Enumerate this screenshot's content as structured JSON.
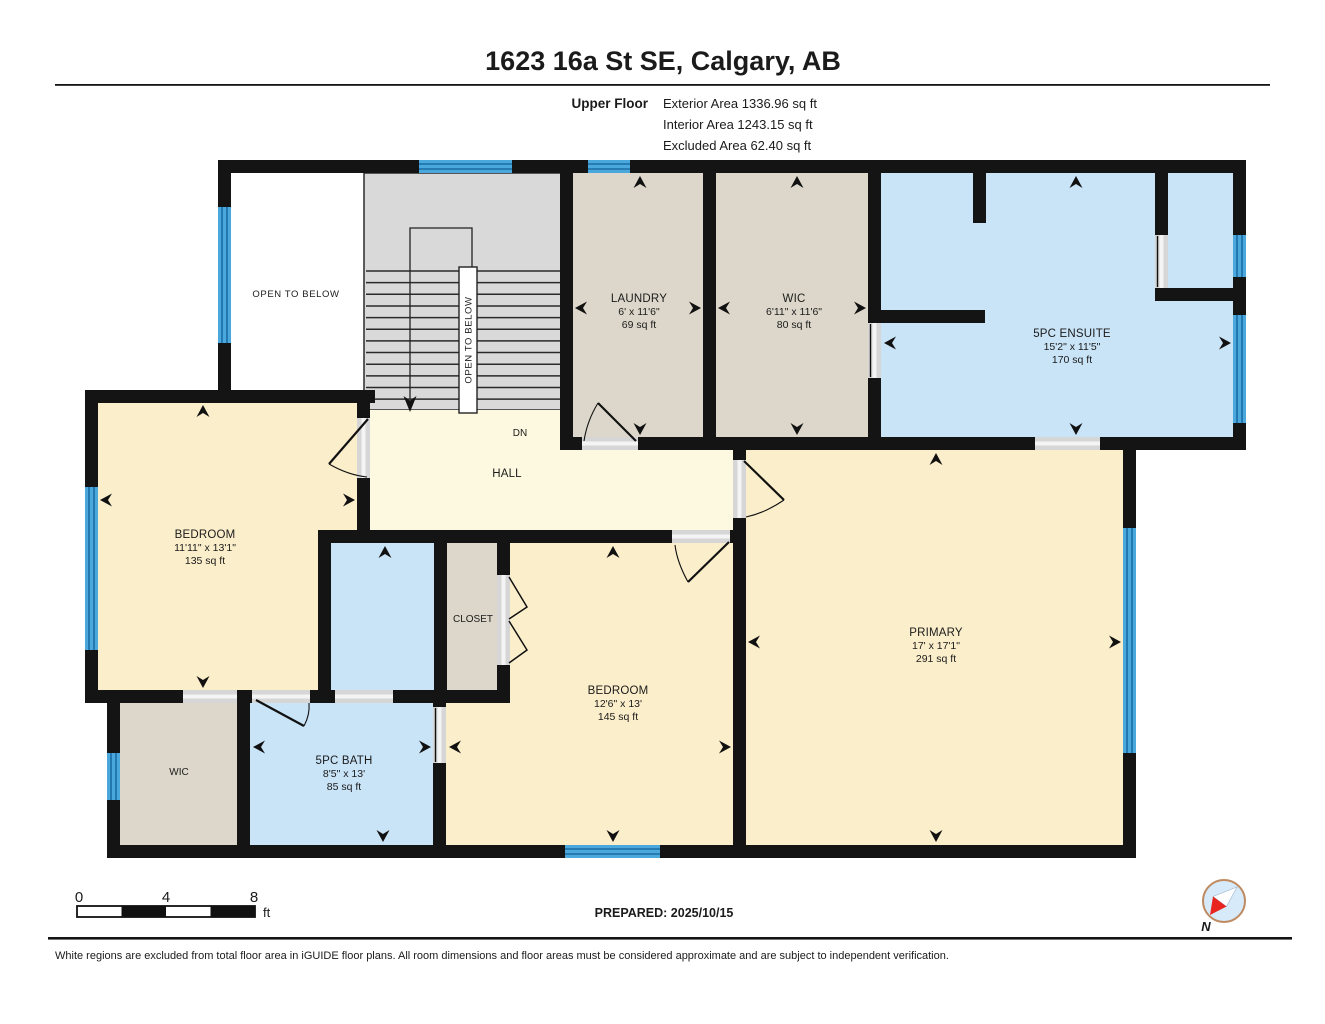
{
  "header": {
    "title": "1623 16a St SE, Calgary, AB",
    "floor_label": "Upper Floor",
    "exterior_area": "Exterior Area 1336.96 sq ft",
    "interior_area": "Interior Area 1243.15 sq ft",
    "excluded_area": "Excluded Area 62.40 sq ft"
  },
  "rooms": {
    "open_to_below": {
      "name": "OPEN TO BELOW"
    },
    "stairwell": {
      "open_label": "OPEN TO BELOW",
      "direction": "DN"
    },
    "hall": {
      "name": "HALL"
    },
    "laundry": {
      "name": "LAUNDRY",
      "dims": "6' x 11'6\"",
      "area": "69 sq ft"
    },
    "wic_upper": {
      "name": "WIC",
      "dims": "6'11\" x 11'6\"",
      "area": "80 sq ft"
    },
    "ensuite": {
      "name": "5PC ENSUITE",
      "dims": "15'2\" x 11'5\"",
      "area": "170 sq ft"
    },
    "bedroom_left": {
      "name": "BEDROOM",
      "dims": "11'11\" x 13'1\"",
      "area": "135 sq ft"
    },
    "closet": {
      "name": "CLOSET"
    },
    "bedroom_middle": {
      "name": "BEDROOM",
      "dims": "12'6\" x 13'",
      "area": "145 sq ft"
    },
    "primary": {
      "name": "PRIMARY",
      "dims": "17' x 17'1\"",
      "area": "291 sq ft"
    },
    "bath": {
      "name": "5PC BATH",
      "dims": "8'5\" x 13'",
      "area": "85 sq ft"
    },
    "wic_lower": {
      "name": "WIC"
    }
  },
  "scale_bar": {
    "t0": "0",
    "t4": "4",
    "t8": "8",
    "unit": "ft"
  },
  "prepared_label": "PREPARED: 2025/10/15",
  "compass_label": "N",
  "disclaimer": "White regions are excluded from total floor area in iGUIDE floor plans. All room dimensions and floor areas must be considered approximate and are subject to independent verification.",
  "colors": {
    "wall": "#141414",
    "room_cream": "#fbeecb",
    "room_hall": "#fdf8e0",
    "room_tan": "#dcd7ca",
    "room_blue": "#c9e3f7",
    "stairs_gray": "#d9d9d9",
    "window_blue": "#4aa8dc",
    "window_line": "#1a6ca5",
    "door_jamb": "#d6d6d6",
    "compass_red": "#e8241f"
  }
}
